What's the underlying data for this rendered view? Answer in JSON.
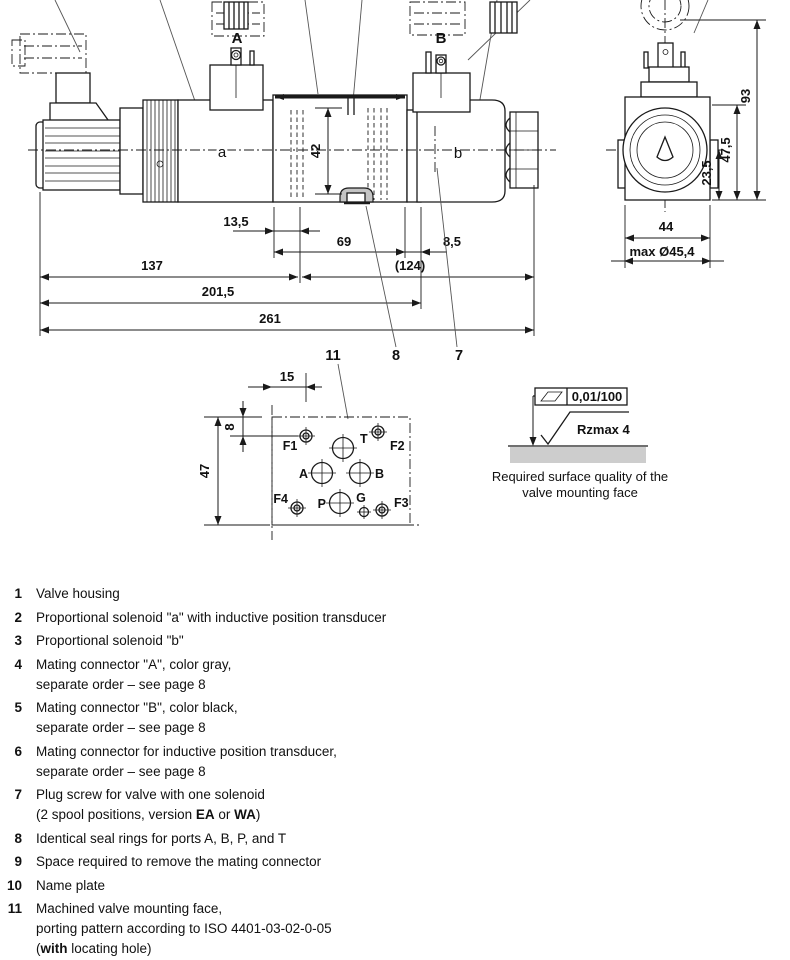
{
  "drawing": {
    "side_view": {
      "connector_a": "A",
      "connector_b": "B",
      "solenoid_a": "a",
      "solenoid_b": "b"
    },
    "dims": {
      "d13_5": "13,5",
      "d69": "69",
      "d8_5": "8,5",
      "d137": "137",
      "d124": "(124)",
      "d201_5": "201,5",
      "d261": "261",
      "d42": "42",
      "d93": "93",
      "d47_5": "47,5",
      "d23_5": "23,5",
      "d44": "44",
      "d45_4": "max Ø45,4"
    },
    "callouts": {
      "c11": "11",
      "c8": "8",
      "c7": "7"
    },
    "face": {
      "d15": "15",
      "d8": "8",
      "d47": "47",
      "f1": "F1",
      "t": "T",
      "f2": "F2",
      "a": "A",
      "b": "B",
      "f4": "F4",
      "p": "P",
      "g": "G",
      "f3": "F3"
    },
    "surface": {
      "flatness": "0,01/100",
      "roughness": "Rzmax 4",
      "caption1": "Required surface quality of the",
      "caption2": "valve mounting face"
    }
  },
  "legend": {
    "items": [
      {
        "num": "1",
        "lines": [
          [
            {
              "t": "Valve housing"
            }
          ]
        ]
      },
      {
        "num": "2",
        "lines": [
          [
            {
              "t": "Proportional solenoid \"a\" with inductive position transducer"
            }
          ]
        ]
      },
      {
        "num": "3",
        "lines": [
          [
            {
              "t": "Proportional solenoid \"b\""
            }
          ]
        ]
      },
      {
        "num": "4",
        "lines": [
          [
            {
              "t": "Mating connector \"A\", color gray,"
            }
          ],
          [
            {
              "t": "separate order – see page 8"
            }
          ]
        ]
      },
      {
        "num": "5",
        "lines": [
          [
            {
              "t": "Mating connector \"B\", color black,"
            }
          ],
          [
            {
              "t": "separate order – see page 8"
            }
          ]
        ]
      },
      {
        "num": "6",
        "lines": [
          [
            {
              "t": "Mating connector for inductive position transducer,"
            }
          ],
          [
            {
              "t": "separate order – see page 8"
            }
          ]
        ]
      },
      {
        "num": "7",
        "lines": [
          [
            {
              "t": "Plug screw for valve with one solenoid"
            }
          ],
          [
            {
              "t": "(2 spool positions, version "
            },
            {
              "t": "EA",
              "b": true
            },
            {
              "t": " or "
            },
            {
              "t": "WA",
              "b": true
            },
            {
              "t": ")"
            }
          ]
        ]
      },
      {
        "num": "8",
        "lines": [
          [
            {
              "t": "Identical seal rings for ports A, B, P, and T"
            }
          ]
        ]
      },
      {
        "num": "9",
        "lines": [
          [
            {
              "t": "Space required to remove the mating connector"
            }
          ]
        ]
      },
      {
        "num": "10",
        "lines": [
          [
            {
              "t": "Name plate"
            }
          ]
        ]
      },
      {
        "num": "11",
        "lines": [
          [
            {
              "t": "Machined valve mounting face,"
            }
          ],
          [
            {
              "t": "porting pattern according to ISO 4401-03-02-0-05"
            }
          ],
          [
            {
              "t": "("
            },
            {
              "t": "with",
              "b": true
            },
            {
              "t": " locating hole)"
            }
          ],
          [
            {
              "t": "Deviation from the standard:"
            }
          ]
        ]
      }
    ]
  }
}
